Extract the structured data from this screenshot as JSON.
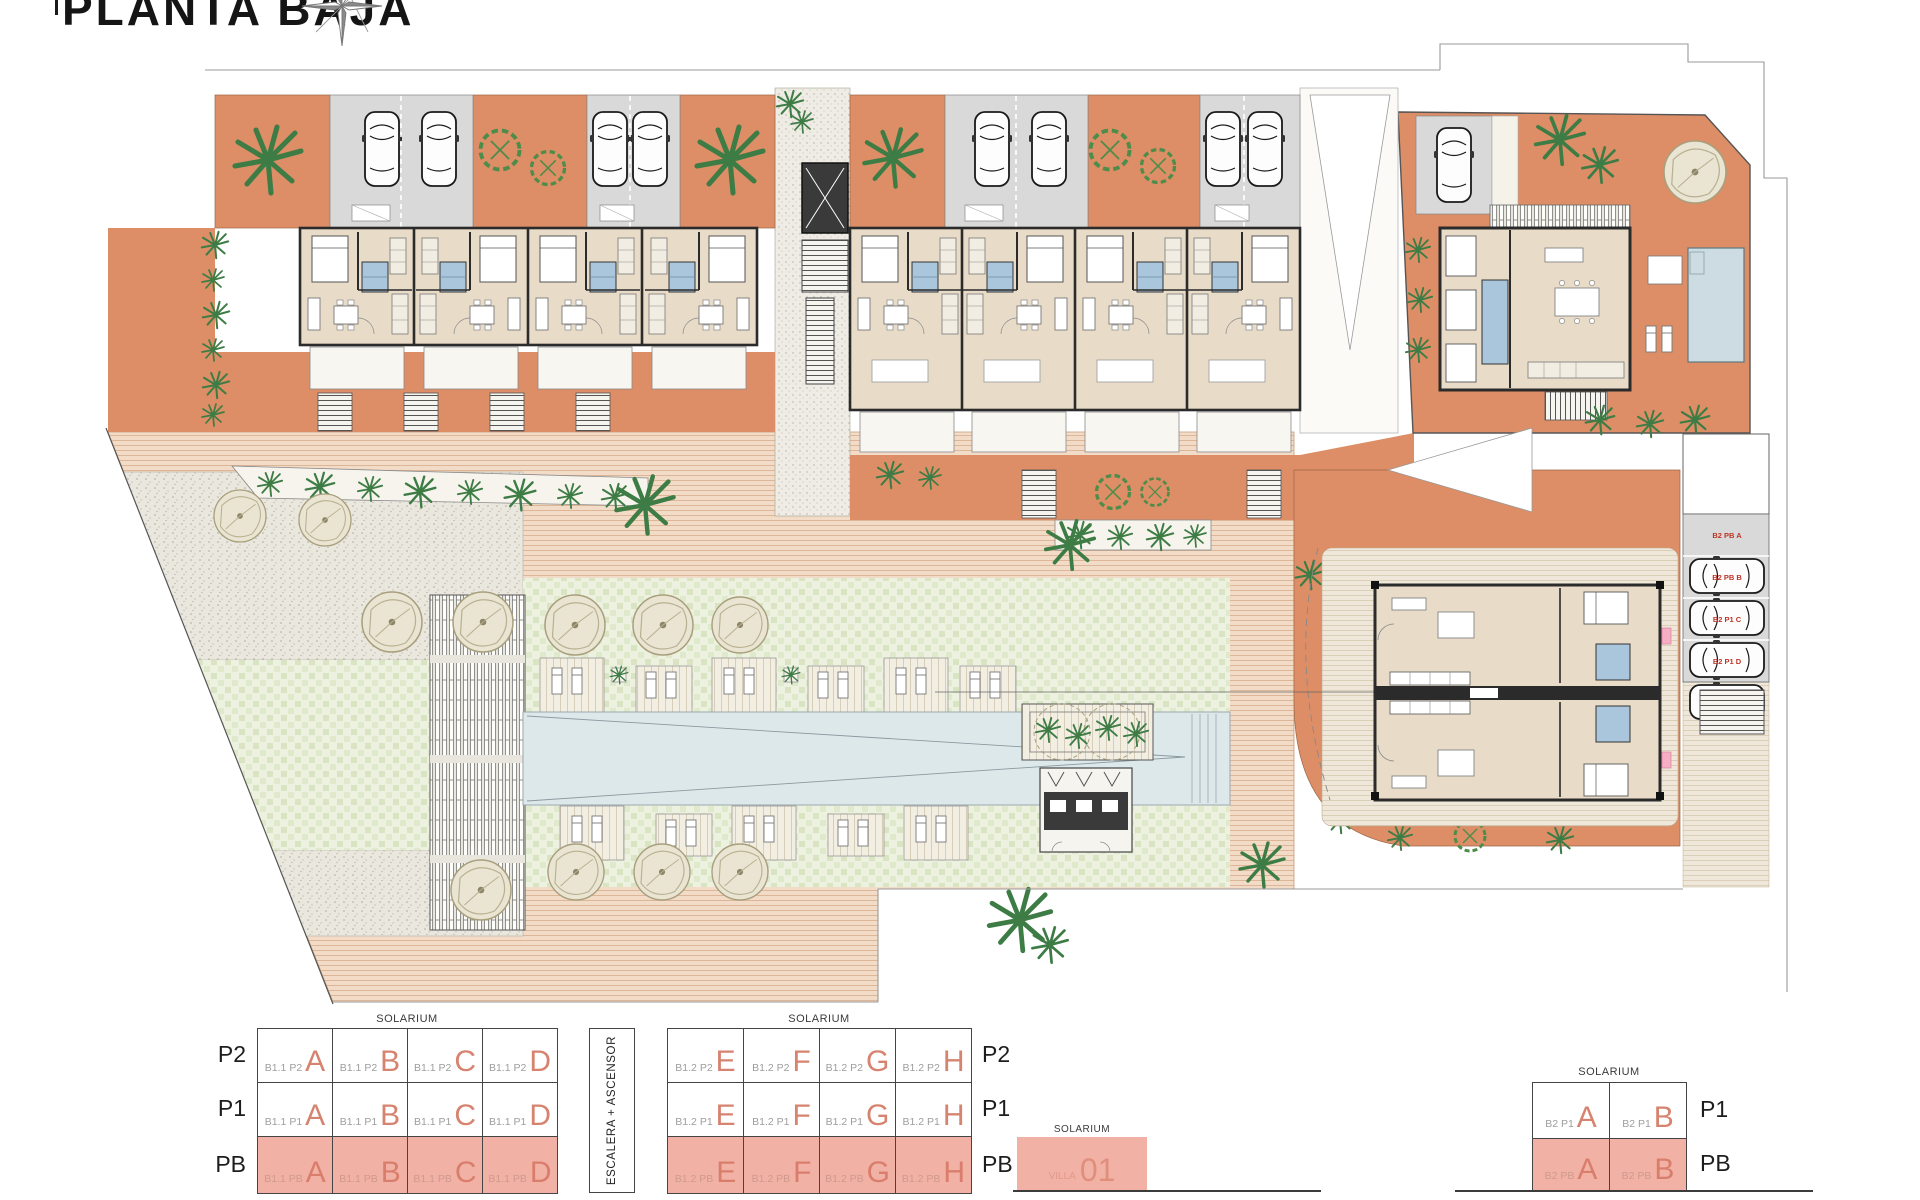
{
  "title": "PLANTA BAJA",
  "colors": {
    "terracotta": "#DD8E66",
    "paving_pink": "#F3DCC7",
    "lawn_green": "#ECF1DE",
    "stone_gray": "#EAE7DF",
    "pool_blue": "#DDE8EA",
    "floor_beige": "#E8DCC8",
    "bath_blue": "#A9C6DC",
    "parking_gray": "#D9D9D9",
    "highlight_pink": "#F2B1A5",
    "accent_salmon": "#D6836F",
    "plant_green": "#3E7C45",
    "parking_label_red": "#C03327"
  },
  "plan": {
    "parking_labels": [
      "B2 PB A",
      "B2 PB B",
      "B2 P1 C",
      "B2 P1 D"
    ]
  },
  "legend": {
    "solarium": "SOLARIUM",
    "stairs": "ESCALERA + ASCENSOR",
    "villa": {
      "code": "VILLA",
      "number": "01"
    },
    "b11": {
      "rows": [
        {
          "floor": "P2",
          "cells": [
            {
              "code": "B1.1 P2",
              "letter": "A"
            },
            {
              "code": "B1.1 P2",
              "letter": "B"
            },
            {
              "code": "B1.1 P2",
              "letter": "C"
            },
            {
              "code": "B1.1 P2",
              "letter": "D"
            }
          ]
        },
        {
          "floor": "P1",
          "cells": [
            {
              "code": "B1.1 P1",
              "letter": "A"
            },
            {
              "code": "B1.1 P1",
              "letter": "B"
            },
            {
              "code": "B1.1 P1",
              "letter": "C"
            },
            {
              "code": "B1.1 P1",
              "letter": "D"
            }
          ]
        },
        {
          "floor": "PB",
          "cells": [
            {
              "code": "B1.1 PB",
              "letter": "A"
            },
            {
              "code": "B1.1 PB",
              "letter": "B"
            },
            {
              "code": "B1.1 PB",
              "letter": "C"
            },
            {
              "code": "B1.1 PB",
              "letter": "D"
            }
          ]
        }
      ]
    },
    "b12": {
      "rows": [
        {
          "floor": "P2",
          "cells": [
            {
              "code": "B1.2 P2",
              "letter": "E"
            },
            {
              "code": "B1.2 P2",
              "letter": "F"
            },
            {
              "code": "B1.2 P2",
              "letter": "G"
            },
            {
              "code": "B1.2 P2",
              "letter": "H"
            }
          ]
        },
        {
          "floor": "P1",
          "cells": [
            {
              "code": "B1.2 P1",
              "letter": "E"
            },
            {
              "code": "B1.2 P1",
              "letter": "F"
            },
            {
              "code": "B1.2 P1",
              "letter": "G"
            },
            {
              "code": "B1.2 P1",
              "letter": "H"
            }
          ]
        },
        {
          "floor": "PB",
          "cells": [
            {
              "code": "B1.2 PB",
              "letter": "E"
            },
            {
              "code": "B1.2 PB",
              "letter": "F"
            },
            {
              "code": "B1.2 PB",
              "letter": "G"
            },
            {
              "code": "B1.2 PB",
              "letter": "H"
            }
          ]
        }
      ]
    },
    "b2": {
      "rows": [
        {
          "floor": "P1",
          "cells": [
            {
              "code": "B2 P1",
              "letter": "A"
            },
            {
              "code": "B2 P1",
              "letter": "B"
            }
          ]
        },
        {
          "floor": "PB",
          "cells": [
            {
              "code": "B2 PB",
              "letter": "A"
            },
            {
              "code": "B2 PB",
              "letter": "B"
            }
          ]
        }
      ]
    }
  }
}
